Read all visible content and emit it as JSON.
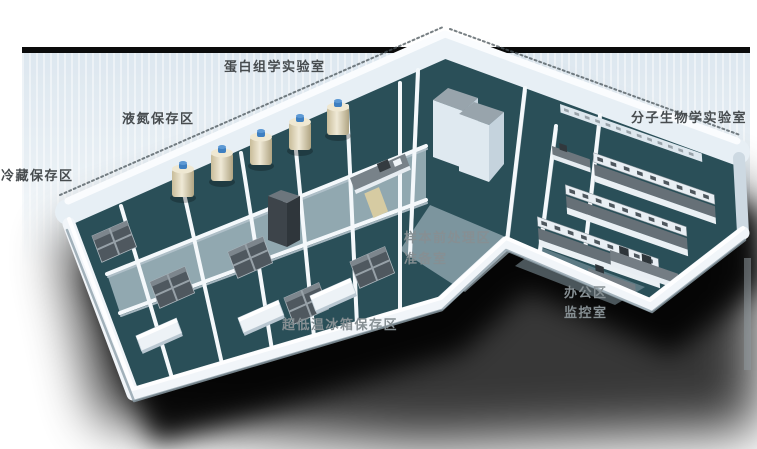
{
  "areas": [
    {
      "id": "proteomics-lab",
      "text": "蛋白组学实验室",
      "tone": "dark"
    },
    {
      "id": "liquid-nitrogen-storage",
      "text": "液氮保存区",
      "tone": "dark"
    },
    {
      "id": "cold-storage",
      "text": "冷藏保存区",
      "tone": "dark"
    },
    {
      "id": "molecular-biology-lab",
      "text": "分子生物学实验室",
      "tone": "dark"
    },
    {
      "id": "sample-pretreatment",
      "text": "样本前处理区",
      "tone": "light"
    },
    {
      "id": "prep-room",
      "text": "准备室",
      "tone": "light"
    },
    {
      "id": "office-area",
      "text": "办公区",
      "tone": "light"
    },
    {
      "id": "monitoring-room",
      "text": "监控室",
      "tone": "light"
    },
    {
      "id": "ult-freezer-storage",
      "text": "超低温冰箱保存区",
      "tone": "light"
    }
  ],
  "equipment": [
    {
      "name": "liquid-nitrogen-tank",
      "count": 5
    },
    {
      "name": "ult-freezer-cluster",
      "count": 5
    },
    {
      "name": "lab-bench-row",
      "count": 3
    },
    {
      "name": "tall-cabinet",
      "count": 2
    },
    {
      "name": "office-desk",
      "count": 2
    }
  ],
  "colors": {
    "label_dark": "#474c4f",
    "label_light": "#868f93",
    "backdrop_blue": "#dde7ef",
    "top_bar_black": "#0b0b0b",
    "floor_teal": "#2a4f58",
    "wall_white": "#eef3f8",
    "tank_cream": "#e6dcc2",
    "tank_cap_blue": "#3e7fc1",
    "freezer_gray": "#4f585f",
    "shadow_black": "#000000"
  }
}
